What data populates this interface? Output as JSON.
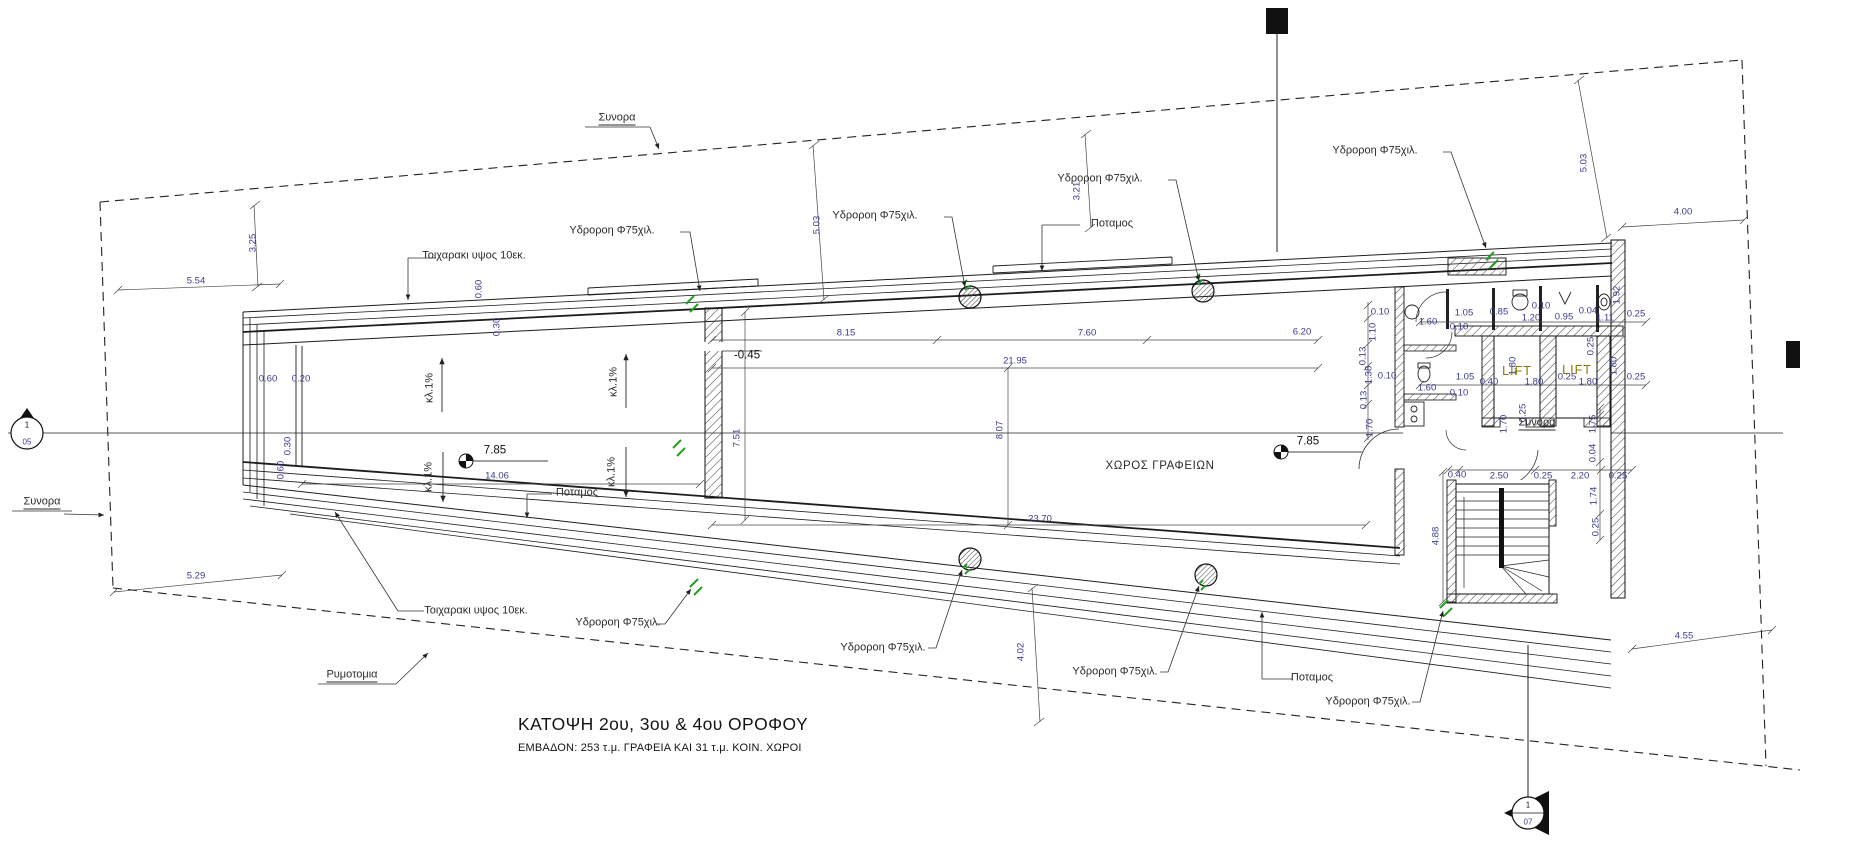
{
  "title_block": {
    "title": "ΚΑΤΟΨΗ 2ου, 3ου & 4ου ΟΡΟΦΟΥ",
    "subtitle": "ΕΜΒΑΔΟΝ: 253 τ.μ. ΓΡΑΦΕΙΑ ΚΑΙ  31 τ.μ. ΚΟΙΝ. ΧΩΡΟΙ"
  },
  "rooms": {
    "office": "ΧΩΡΟΣ ΓΡΑΦΕΙΩΝ",
    "lift_a": "LIFT",
    "lift_b": "LIFT"
  },
  "section_markers": [
    {
      "num": "1",
      "sheet": "05"
    },
    {
      "num": "1",
      "sheet": "07"
    }
  ],
  "colors": {
    "line": "#1c1c1c",
    "dim_text": "#3b3b8d",
    "note_text": "#2b2b2b",
    "drain_green": "#1fa01f",
    "lift_text": "#827c00"
  },
  "annotations": {
    "levels": [
      {
        "t": "7.85",
        "x": 495,
        "y": 451
      },
      {
        "t": "7.85",
        "x": 1308,
        "y": 442
      },
      {
        "t": "-0.45",
        "x": 747,
        "y": 356
      }
    ],
    "notes": [
      {
        "t": "Συνορα",
        "x": 617,
        "y": 119,
        "u": 1
      },
      {
        "t": "Συνορα",
        "x": 42,
        "y": 503,
        "u": 1
      },
      {
        "t": "Συνορα",
        "x": 1537,
        "y": 424,
        "u": 1
      },
      {
        "t": "Ρυμοτομια",
        "x": 352,
        "y": 676,
        "u": 1
      },
      {
        "t": "Ποταμος",
        "x": 1112,
        "y": 224
      },
      {
        "t": "Ποταμος",
        "x": 577,
        "y": 493
      },
      {
        "t": "Ποταμος",
        "x": 1312,
        "y": 678
      },
      {
        "t": "Τοιχαρακι υψος  10εκ.",
        "x": 474,
        "y": 256
      },
      {
        "t": "Τοιχαρακι υψος  10εκ.",
        "x": 476,
        "y": 611
      },
      {
        "t": "Υδροροη Φ75χιλ.",
        "x": 612,
        "y": 231
      },
      {
        "t": "Υδροροη Φ75χιλ.",
        "x": 875,
        "y": 216
      },
      {
        "t": "Υδροροη Φ75χιλ.",
        "x": 1100,
        "y": 179
      },
      {
        "t": "Υδροροη Φ75χιλ.",
        "x": 1375,
        "y": 151
      },
      {
        "t": "Υδροροη Φ75χιλ.",
        "x": 618,
        "y": 623
      },
      {
        "t": "Υδροροη Φ75χιλ.",
        "x": 883,
        "y": 648
      },
      {
        "t": "Υδροροη Φ75χιλ.",
        "x": 1115,
        "y": 672
      },
      {
        "t": "Υδροροη Φ75χιλ.",
        "x": 1368,
        "y": 702
      },
      {
        "t": "κλ.1%",
        "x": 430,
        "y": 388,
        "r": 1
      },
      {
        "t": "κλ.1%",
        "x": 614,
        "y": 382,
        "r": 1
      },
      {
        "t": "κλ.1%",
        "x": 429,
        "y": 477,
        "r": 1
      },
      {
        "t": "κλ.1%",
        "x": 612,
        "y": 472,
        "r": 1
      }
    ],
    "dimensions": [
      {
        "t": "5.54",
        "x": 196,
        "y": 281
      },
      {
        "t": "3.25",
        "x": 253,
        "y": 243,
        "r": 1
      },
      {
        "t": "5.29",
        "x": 196,
        "y": 576
      },
      {
        "t": "0.60",
        "x": 268,
        "y": 379
      },
      {
        "t": "0.20",
        "x": 301,
        "y": 379
      },
      {
        "t": "0.60",
        "x": 479,
        "y": 289,
        "r": 1
      },
      {
        "t": "0.30",
        "x": 497,
        "y": 327,
        "r": 1
      },
      {
        "t": "0.30",
        "x": 288,
        "y": 446,
        "r": 1
      },
      {
        "t": "0.60",
        "x": 281,
        "y": 470,
        "r": 1
      },
      {
        "t": "14.06",
        "x": 497,
        "y": 476
      },
      {
        "t": "7.51",
        "x": 737,
        "y": 438,
        "r": 1
      },
      {
        "t": "8.15",
        "x": 846,
        "y": 333
      },
      {
        "t": "7.60",
        "x": 1087,
        "y": 333
      },
      {
        "t": "6.20",
        "x": 1302,
        "y": 332
      },
      {
        "t": "21.95",
        "x": 1015,
        "y": 361
      },
      {
        "t": "8.07",
        "x": 1000,
        "y": 430,
        "r": 1
      },
      {
        "t": "23.70",
        "x": 1040,
        "y": 519
      },
      {
        "t": "3.21",
        "x": 1077,
        "y": 191,
        "r": 1
      },
      {
        "t": "5.03",
        "x": 817,
        "y": 225,
        "r": 1
      },
      {
        "t": "5.03",
        "x": 1584,
        "y": 163,
        "r": 1
      },
      {
        "t": "4.02",
        "x": 1021,
        "y": 652,
        "r": 1
      },
      {
        "t": "4.00",
        "x": 1683,
        "y": 212
      },
      {
        "t": "4.55",
        "x": 1684,
        "y": 636
      },
      {
        "t": "4.88",
        "x": 1436,
        "y": 536,
        "r": 1
      },
      {
        "t": "1.05",
        "x": 1464,
        "y": 313
      },
      {
        "t": "0.85",
        "x": 1499,
        "y": 312
      },
      {
        "t": "1.20",
        "x": 1531,
        "y": 318
      },
      {
        "t": "0.10",
        "x": 1541,
        "y": 306
      },
      {
        "t": "0.95",
        "x": 1564,
        "y": 317
      },
      {
        "t": "0.04",
        "x": 1588,
        "y": 311
      },
      {
        "t": "1.11",
        "x": 1605,
        "y": 318
      },
      {
        "t": "1.92",
        "x": 1617,
        "y": 295,
        "r": 1
      },
      {
        "t": "0.25",
        "x": 1636,
        "y": 314
      },
      {
        "t": "1.60",
        "x": 1428,
        "y": 322
      },
      {
        "t": "0.10",
        "x": 1459,
        "y": 327
      },
      {
        "t": "1.05",
        "x": 1465,
        "y": 377
      },
      {
        "t": "1.60",
        "x": 1427,
        "y": 388
      },
      {
        "t": "0.10",
        "x": 1459,
        "y": 393
      },
      {
        "t": "0.40",
        "x": 1489,
        "y": 382
      },
      {
        "t": "1.80",
        "x": 1513,
        "y": 366,
        "r": 1
      },
      {
        "t": "1.80",
        "x": 1534,
        "y": 382
      },
      {
        "t": "0.25",
        "x": 1567,
        "y": 377
      },
      {
        "t": "1.80",
        "x": 1588,
        "y": 382
      },
      {
        "t": "1.80",
        "x": 1614,
        "y": 366,
        "r": 1
      },
      {
        "t": "0.25",
        "x": 1591,
        "y": 346,
        "r": 1
      },
      {
        "t": "0.25",
        "x": 1636,
        "y": 377
      },
      {
        "t": "0.40",
        "x": 1457,
        "y": 475
      },
      {
        "t": "2.50",
        "x": 1499,
        "y": 476
      },
      {
        "t": "0.25",
        "x": 1543,
        "y": 476
      },
      {
        "t": "2.20",
        "x": 1580,
        "y": 476
      },
      {
        "t": "0.25",
        "x": 1618,
        "y": 476
      },
      {
        "t": "1.70",
        "x": 1504,
        "y": 424,
        "r": 1
      },
      {
        "t": "0.25",
        "x": 1523,
        "y": 413,
        "r": 1
      },
      {
        "t": "1.75",
        "x": 1593,
        "y": 424,
        "r": 1
      },
      {
        "t": "0.04",
        "x": 1593,
        "y": 453,
        "r": 1
      },
      {
        "t": "1.74",
        "x": 1594,
        "y": 496,
        "r": 1
      },
      {
        "t": "0.25",
        "x": 1596,
        "y": 527,
        "r": 1
      },
      {
        "t": "0.10",
        "x": 1380,
        "y": 312
      },
      {
        "t": "1.10",
        "x": 1373,
        "y": 332,
        "r": 1
      },
      {
        "t": "0.13",
        "x": 1363,
        "y": 356,
        "r": 1
      },
      {
        "t": "1.38",
        "x": 1369,
        "y": 375,
        "r": 1
      },
      {
        "t": "0.10",
        "x": 1387,
        "y": 376
      },
      {
        "t": "0.13",
        "x": 1364,
        "y": 400,
        "r": 1
      },
      {
        "t": "1.70",
        "x": 1370,
        "y": 428,
        "r": 1
      }
    ]
  }
}
